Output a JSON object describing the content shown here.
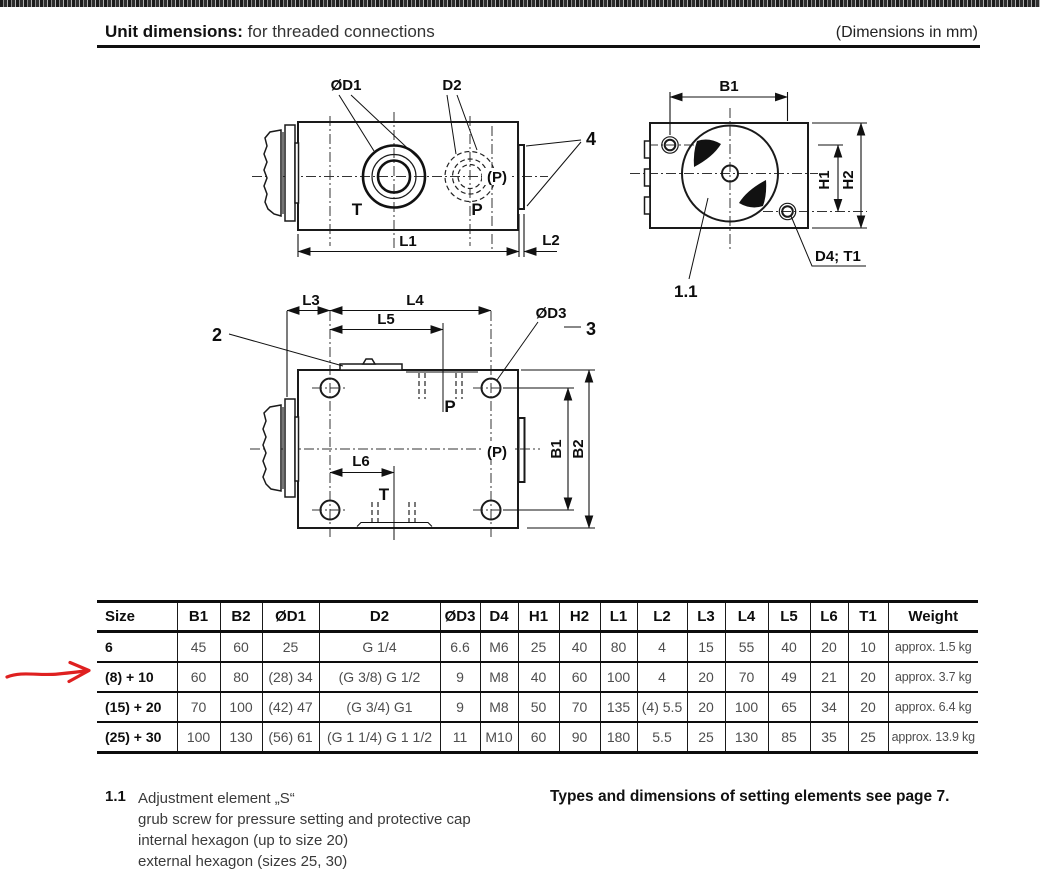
{
  "header": {
    "title_bold": "Unit dimensions:",
    "title_suffix": "for threaded connections",
    "dimensions_note": "(Dimensions in mm)"
  },
  "drawings": {
    "front_view": {
      "od1_label": "ØD1",
      "d2_label": "D2",
      "item_4": "4",
      "p_paren": "(P)",
      "t_port": "T",
      "p_port": "P",
      "l1": "L1",
      "l2": "L2"
    },
    "end_view": {
      "b1": "B1",
      "h1": "H1",
      "h2": "H2",
      "d4_t1": "D4; T1",
      "item_1_1": "1.1"
    },
    "top_view": {
      "item_2": "2",
      "item_3": "3",
      "od3_label": "ØD3",
      "l3": "L3",
      "l4": "L4",
      "l5": "L5",
      "l6": "L6",
      "p_port": "P",
      "p_paren": "(P)",
      "t_port": "T",
      "b1": "B1",
      "b2": "B2"
    }
  },
  "annotation": {
    "red_arrow_color": "#df2020"
  },
  "table": {
    "columns": [
      "Size",
      "B1",
      "B2",
      "ØD1",
      "D2",
      "ØD3",
      "D4",
      "H1",
      "H2",
      "L1",
      "L2",
      "L3",
      "L4",
      "L5",
      "L6",
      "T1",
      "Weight"
    ],
    "rows": [
      [
        "6",
        "45",
        "60",
        "25",
        "G 1/4",
        "6.6",
        "M6",
        "25",
        "40",
        "80",
        "4",
        "15",
        "55",
        "40",
        "20",
        "10",
        "approx. 1.5 kg"
      ],
      [
        "(8) + 10",
        "60",
        "80",
        "(28) 34",
        "(G 3/8) G 1/2",
        "9",
        "M8",
        "40",
        "60",
        "100",
        "4",
        "20",
        "70",
        "49",
        "21",
        "20",
        "approx. 3.7 kg"
      ],
      [
        "(15) + 20",
        "70",
        "100",
        "(42) 47",
        "(G 3/4) G1",
        "9",
        "M8",
        "50",
        "70",
        "135",
        "(4) 5.5",
        "20",
        "100",
        "65",
        "34",
        "20",
        "approx. 6.4 kg"
      ],
      [
        "(25) + 30",
        "100",
        "130",
        "(56) 61",
        "(G 1 1/4) G 1 1/2",
        "11",
        "M10",
        "60",
        "90",
        "180",
        "5.5",
        "25",
        "130",
        "85",
        "35",
        "25",
        "approx. 13.9 kg"
      ]
    ]
  },
  "notes": {
    "item_number": "1.1",
    "line1": "Adjustment element „S“",
    "line2": "grub screw for pressure setting and protective cap",
    "line3": "internal hexagon (up to size 20)",
    "line4": "external hexagon (sizes 25, 30)",
    "right_note": "Types and dimensions of setting elements see page 7."
  }
}
